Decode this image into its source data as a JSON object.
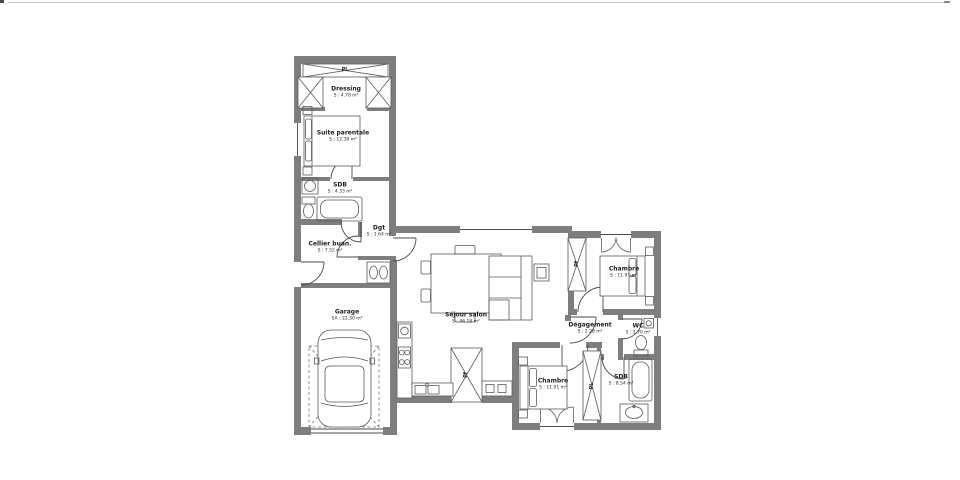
{
  "colors": {
    "background": "#ffffff",
    "wall": "#7e7e7e",
    "line": "#4a4a4a",
    "furniture": "#5a5a5a",
    "text": "#1c1c1c"
  },
  "rooms": [
    {
      "id": "dressing",
      "name": "Dressing",
      "area": "S : 4.78 m²"
    },
    {
      "id": "suite",
      "name": "Suite parentale",
      "area": "S : 12.38 m²"
    },
    {
      "id": "sdb1",
      "name": "SDB",
      "area": "S : 4.33 m²"
    },
    {
      "id": "dgt",
      "name": "Dgt",
      "area": "S : 1.64 m²"
    },
    {
      "id": "cellier",
      "name": "Cellier buan.",
      "area": "S : 7.52 m²"
    },
    {
      "id": "garage",
      "name": "Garage",
      "area": "SA : 22.30 m²"
    },
    {
      "id": "sejour",
      "name": "Séjour salon",
      "area": "S : 46.18 m²"
    },
    {
      "id": "chambre1",
      "name": "Chambre",
      "area": "S : 11.91 m²"
    },
    {
      "id": "degagement",
      "name": "Dégagement",
      "area": "S : 2.28 m²"
    },
    {
      "id": "wc",
      "name": "WC",
      "area": "S : 1.70 m²"
    },
    {
      "id": "chambre2",
      "name": "Chambre",
      "area": "S : 11.01 m²"
    },
    {
      "id": "sdb2",
      "name": "SDB",
      "area": "S : 8.54 m²"
    }
  ],
  "closets": [
    {
      "label": "PL"
    },
    {
      "label": "Pf"
    },
    {
      "label": "Pf"
    },
    {
      "label": "PL"
    }
  ]
}
